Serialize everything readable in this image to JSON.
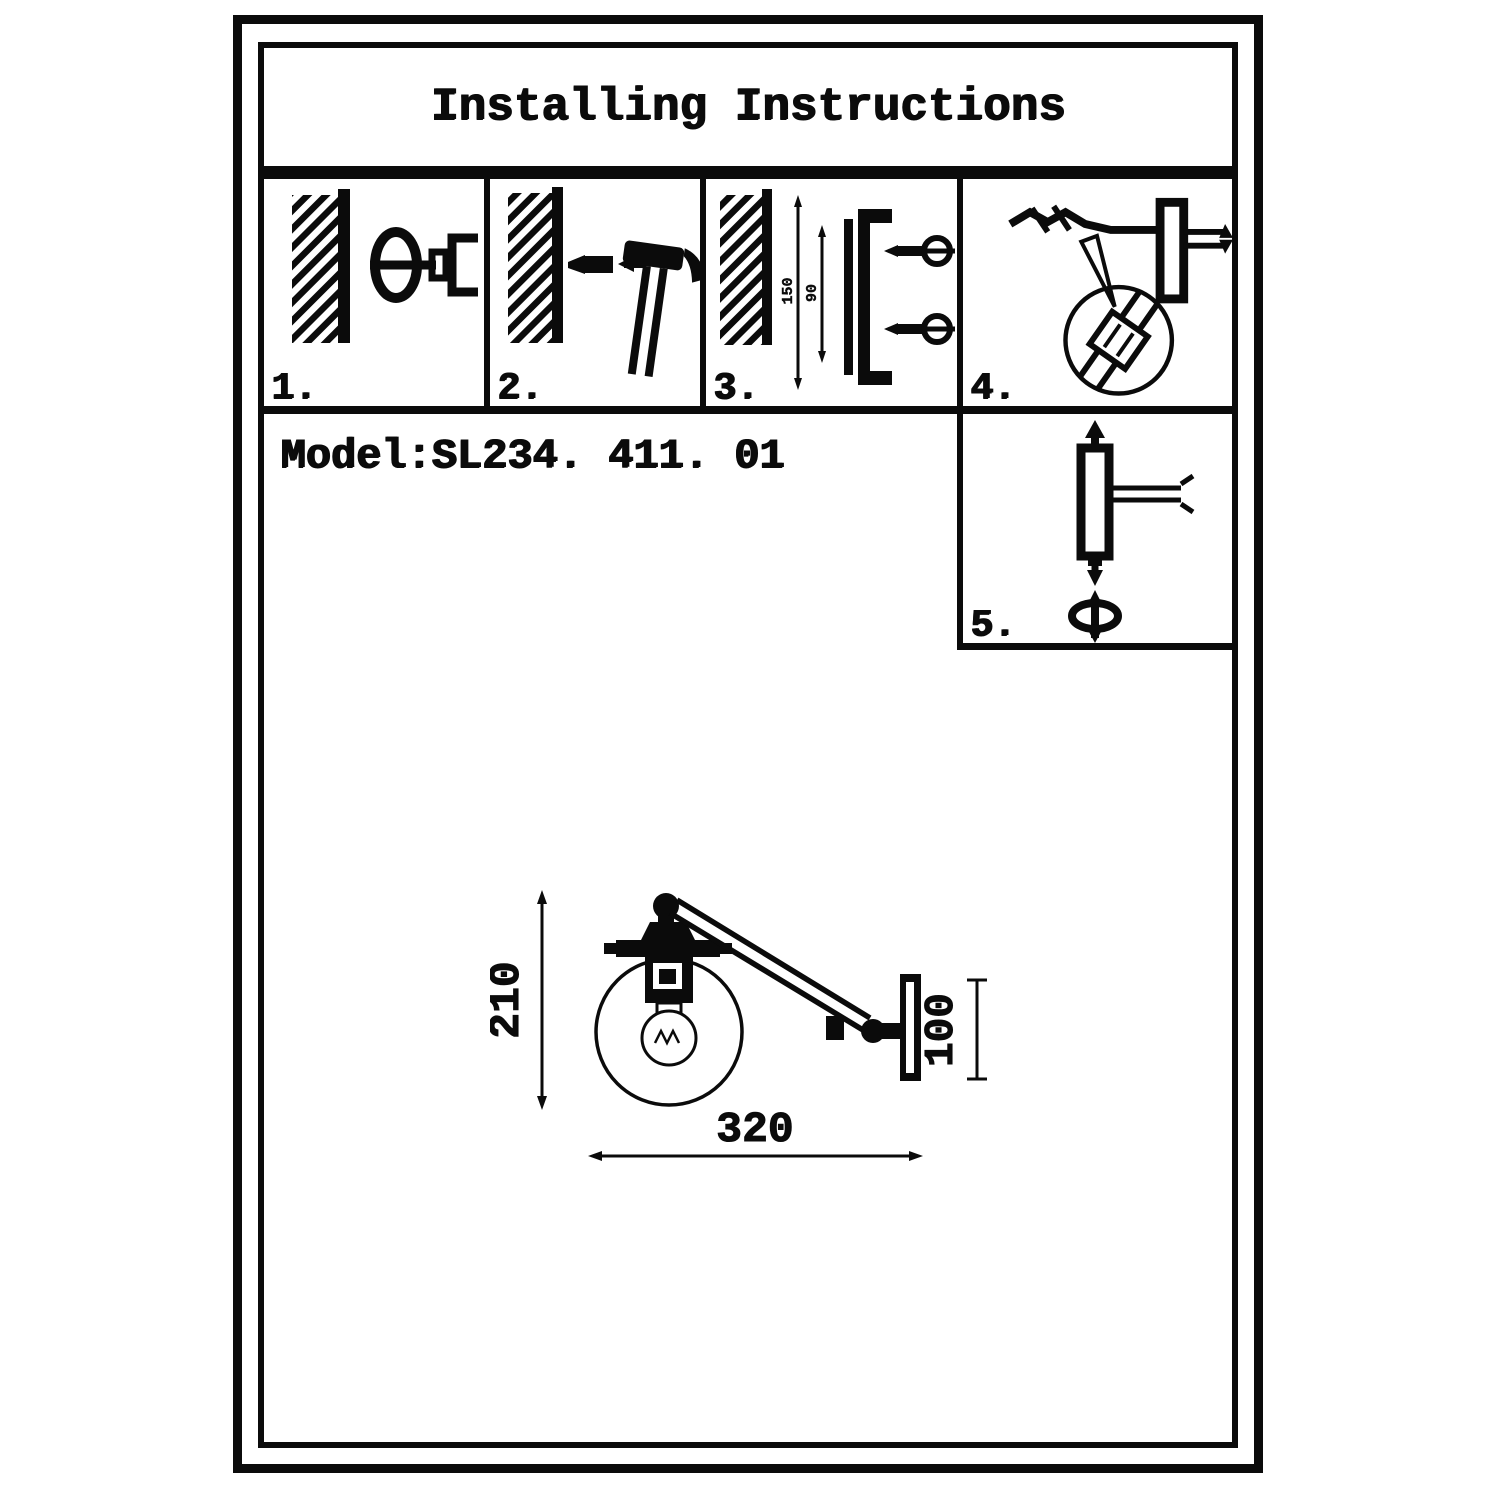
{
  "colors": {
    "ink": "#0b0b0b",
    "paper": "#ffffff"
  },
  "header": {
    "title": "Installing Instructions"
  },
  "model": {
    "label": "Model:SL234. 411. 01"
  },
  "steps": [
    {
      "number": "1.",
      "icon": "drill-hole-in-wall-icon"
    },
    {
      "number": "2.",
      "icon": "hammer-anchor-into-wall-icon"
    },
    {
      "number": "3.",
      "icon": "mount-bracket-with-screws-icon",
      "dims": {
        "outer": "150",
        "inner": "90"
      }
    },
    {
      "number": "4.",
      "icon": "connect-wires-detail-icon"
    },
    {
      "number": "5.",
      "icon": "attach-arm-tighten-screw-icon"
    }
  ],
  "diagram": {
    "name": "wall-lamp-dimension-drawing",
    "height": "210",
    "plate_height": "100",
    "reach": "320"
  }
}
